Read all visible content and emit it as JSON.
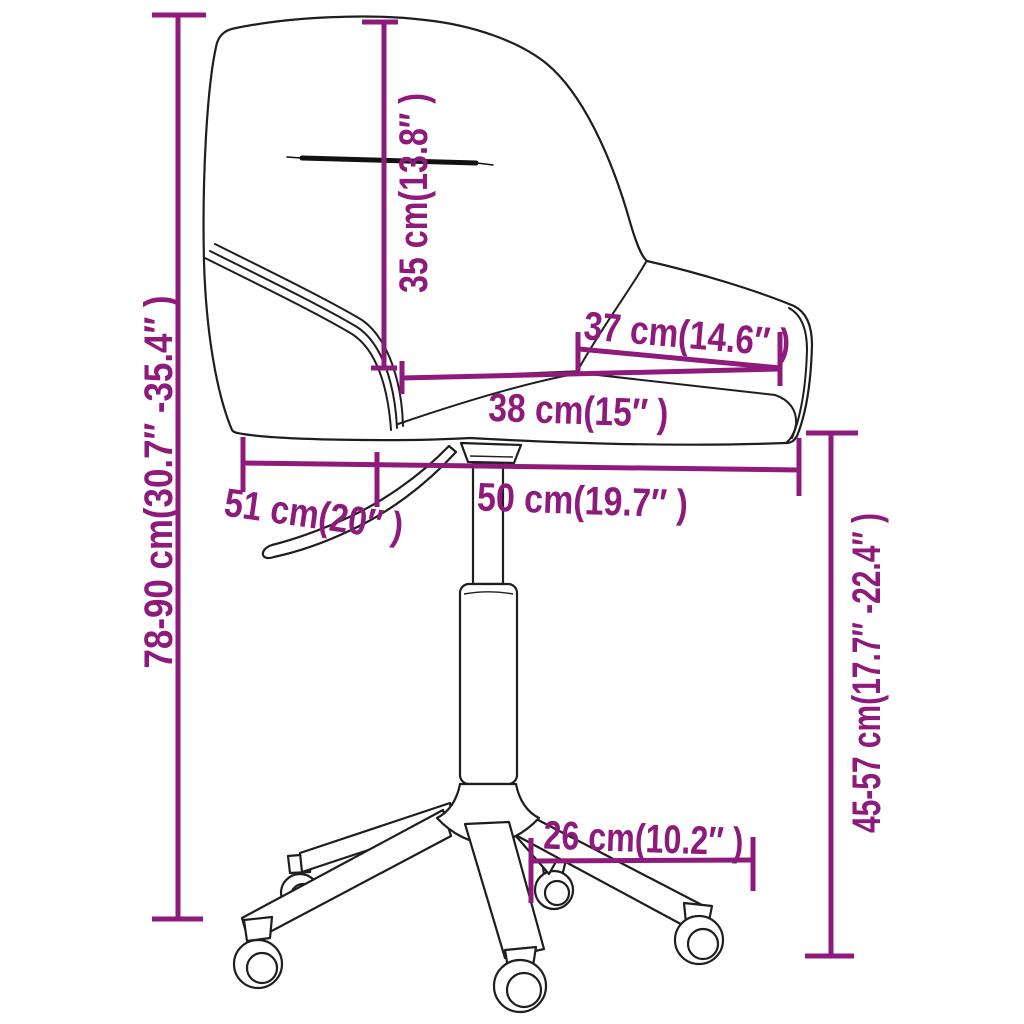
{
  "diagram": {
    "title": "swivel office chair dimension diagram",
    "background_color": "#ffffff",
    "accent_color": "#8E1A7C",
    "line_art_color": "#1e1e1e",
    "labels": {
      "backrest_height": "35 cm(13.8″ )",
      "seat_width": "37 cm(14.6″ )",
      "seat_depth": "38 cm(15″ )",
      "overall_width": "50 cm(19.7″ )",
      "overall_depth": "51 cm(20″ )",
      "base_leg_length": "26 cm(10.2″ )",
      "overall_height_range": "78-90 cm(30.7″ -35.4″ )",
      "seat_height_range": "45-57 cm(17.7″ -22.4″ )"
    },
    "values": {
      "backrest_height_cm": 35,
      "backrest_height_in": 13.8,
      "seat_width_cm": 37,
      "seat_width_in": 14.6,
      "seat_depth_cm": 38,
      "seat_depth_in": 15,
      "overall_width_cm": 50,
      "overall_width_in": 19.7,
      "overall_depth_cm": 51,
      "overall_depth_in": 20,
      "base_leg_length_cm": 26,
      "base_leg_length_in": 10.2,
      "overall_height_min_cm": 78,
      "overall_height_max_cm": 90,
      "overall_height_min_in": 30.7,
      "overall_height_max_in": 35.4,
      "seat_height_min_cm": 45,
      "seat_height_max_cm": 57,
      "seat_height_min_in": 17.7,
      "seat_height_max_in": 22.4
    }
  }
}
